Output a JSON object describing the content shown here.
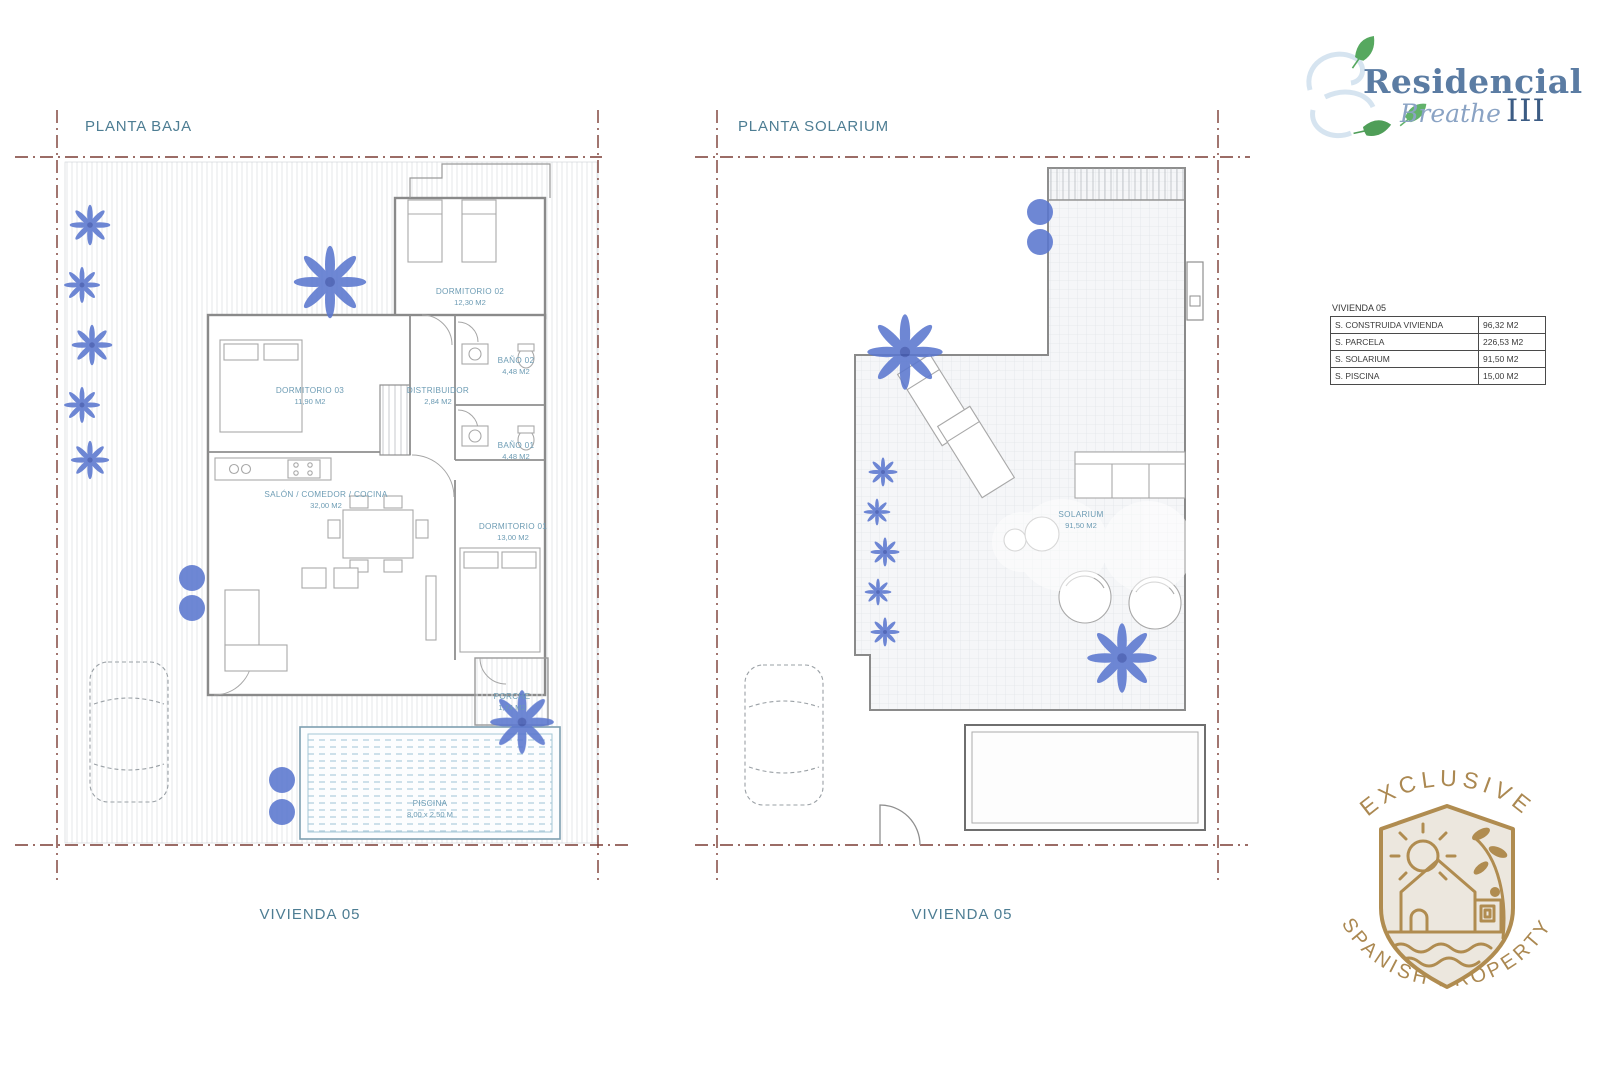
{
  "logo": {
    "line1": "Residencial",
    "line2": "Breathe",
    "line3": "III"
  },
  "plans": {
    "left": {
      "title": "PLANTA BAJA",
      "footer": "VIVIENDA 05",
      "rooms": [
        {
          "name": "DORMITORIO 02",
          "area": "12,30 M2"
        },
        {
          "name": "BAÑO 02",
          "area": "4,48 M2"
        },
        {
          "name": "DORMITORIO 03",
          "area": "11,90 M2"
        },
        {
          "name": "DISTRIBUIDOR",
          "area": "2,84 M2"
        },
        {
          "name": "BAÑO 01",
          "area": "4,48 M2"
        },
        {
          "name": "SALÓN / COMEDOR / COCINA",
          "area": "32,00 M2"
        },
        {
          "name": "DORMITORIO 01",
          "area": "13,00 M2"
        },
        {
          "name": "PORCHE",
          "area": "1,74 M2"
        },
        {
          "name": "PISCINA",
          "area": "8,00 x 2,50 M"
        }
      ]
    },
    "right": {
      "title": "PLANTA SOLARIUM",
      "footer": "VIVIENDA 05",
      "rooms": [
        {
          "name": "SOLARIUM",
          "area": "91,50 M2"
        }
      ]
    }
  },
  "summary_table": {
    "title": "VIVIENDA 05",
    "rows": [
      {
        "label": "S. CONSTRUIDA VIVIENDA",
        "value": "96,32 M2"
      },
      {
        "label": "S. PARCELA",
        "value": "226,53 M2"
      },
      {
        "label": "S. SOLARIUM",
        "value": "91,50 M2"
      },
      {
        "label": "S. PISCINA",
        "value": "15,00 M2"
      }
    ]
  },
  "badge": {
    "top_text": "EXCLUSIVE",
    "bottom_text": "SPANISH PROPERTY"
  },
  "colors": {
    "accent_teal": "#4d7d93",
    "boundary_maroon": "#7a3c34",
    "plant_blue": "#5b77cf",
    "pool_blue": "#b9d4e1",
    "wall_gray": "#8a8a8a",
    "logo_blue": "#5b7ca3",
    "leaf_green": "#56a85f",
    "badge_gold": "#b08c50"
  }
}
